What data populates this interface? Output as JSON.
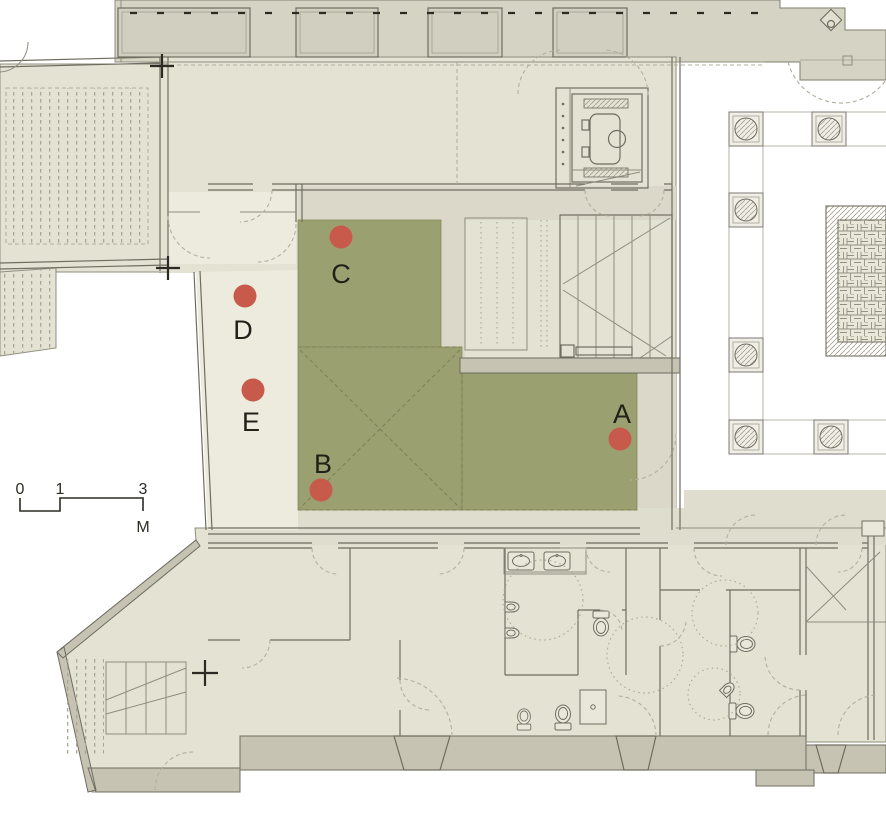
{
  "colors": {
    "marker": "#c85a4c",
    "zone": "#9aa06f",
    "zone_stroke": "#858a5e"
  },
  "markers": [
    {
      "label": "A",
      "x": 620,
      "y": 439,
      "label_dy": -16
    },
    {
      "label": "B",
      "x": 321,
      "y": 490,
      "label_dy": -17
    },
    {
      "label": "C",
      "x": 341,
      "y": 237,
      "label_dy": 46
    },
    {
      "label": "D",
      "x": 245,
      "y": 296,
      "label_dy": 43
    },
    {
      "label": "E",
      "x": 253,
      "y": 390,
      "label_dy": 41
    }
  ],
  "scale_bar": {
    "ticks": [
      "0",
      "1",
      "3"
    ],
    "unit": "M"
  }
}
